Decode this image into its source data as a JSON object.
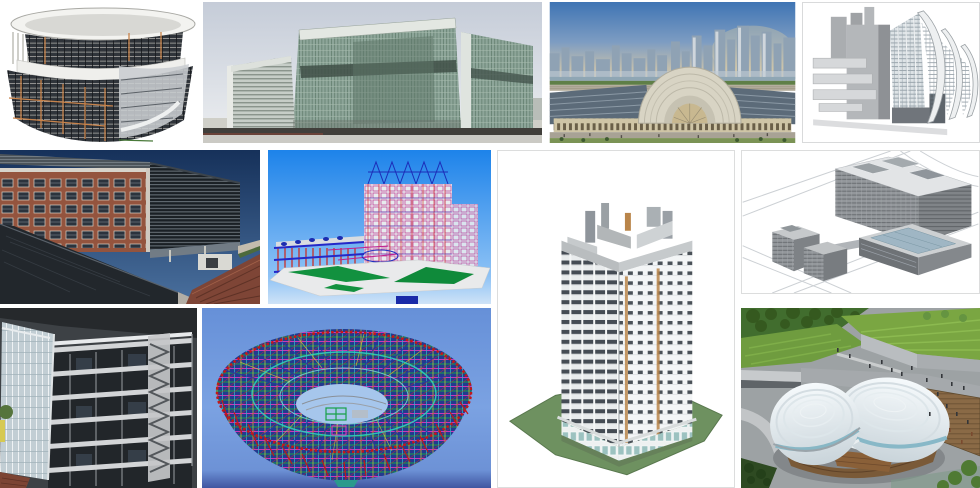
{
  "page": {
    "background": "#ffffff"
  },
  "gallery": {
    "items": [
      {
        "name": "Cylindrical curtain-wall building 3D model",
        "palette": [
          "#ffffff",
          "#2f343a",
          "#c8834b"
        ]
      },
      {
        "name": "Glass convention center elevation render",
        "palette": [
          "#c5ccd8",
          "#8da599",
          "#413f3b"
        ]
      },
      {
        "name": "Exhibition hall with city skyline aerial render",
        "palette": [
          "#3f74b4",
          "#d8d4c4",
          "#5c6b79"
        ]
      },
      {
        "name": "Curved-sail theater massing model",
        "palette": [
          "#ffffff",
          "#b4b7ba",
          "#6e7c86"
        ]
      },
      {
        "name": "Brick office building with louver screen render",
        "palette": [
          "#16315a",
          "#94543e",
          "#22272c"
        ]
      },
      {
        "name": "Construction site BIM wireframe model",
        "palette": [
          "#1d83ea",
          "#d02418",
          "#12913f"
        ]
      },
      {
        "name": "High-rise residential tower axonometric model",
        "palette": [
          "#ffffff",
          "#454c54",
          "#6e9160"
        ]
      },
      {
        "name": "Mixed-use complex isometric BIM model",
        "palette": [
          "#ffffff",
          "#93979b",
          "#9fb6c4"
        ]
      },
      {
        "name": "Concrete frame building section cutaway",
        "palette": [
          "#22262a",
          "#d2d4d6",
          "#c2ced4"
        ]
      },
      {
        "name": "Stadium bowl structural steel frame model",
        "palette": [
          "#6b93da",
          "#c41818",
          "#18a04a"
        ]
      },
      {
        "name": "Domed cultural center aerial render",
        "palette": [
          "#7aa642",
          "#f6fafc",
          "#9da2a4"
        ]
      }
    ]
  }
}
